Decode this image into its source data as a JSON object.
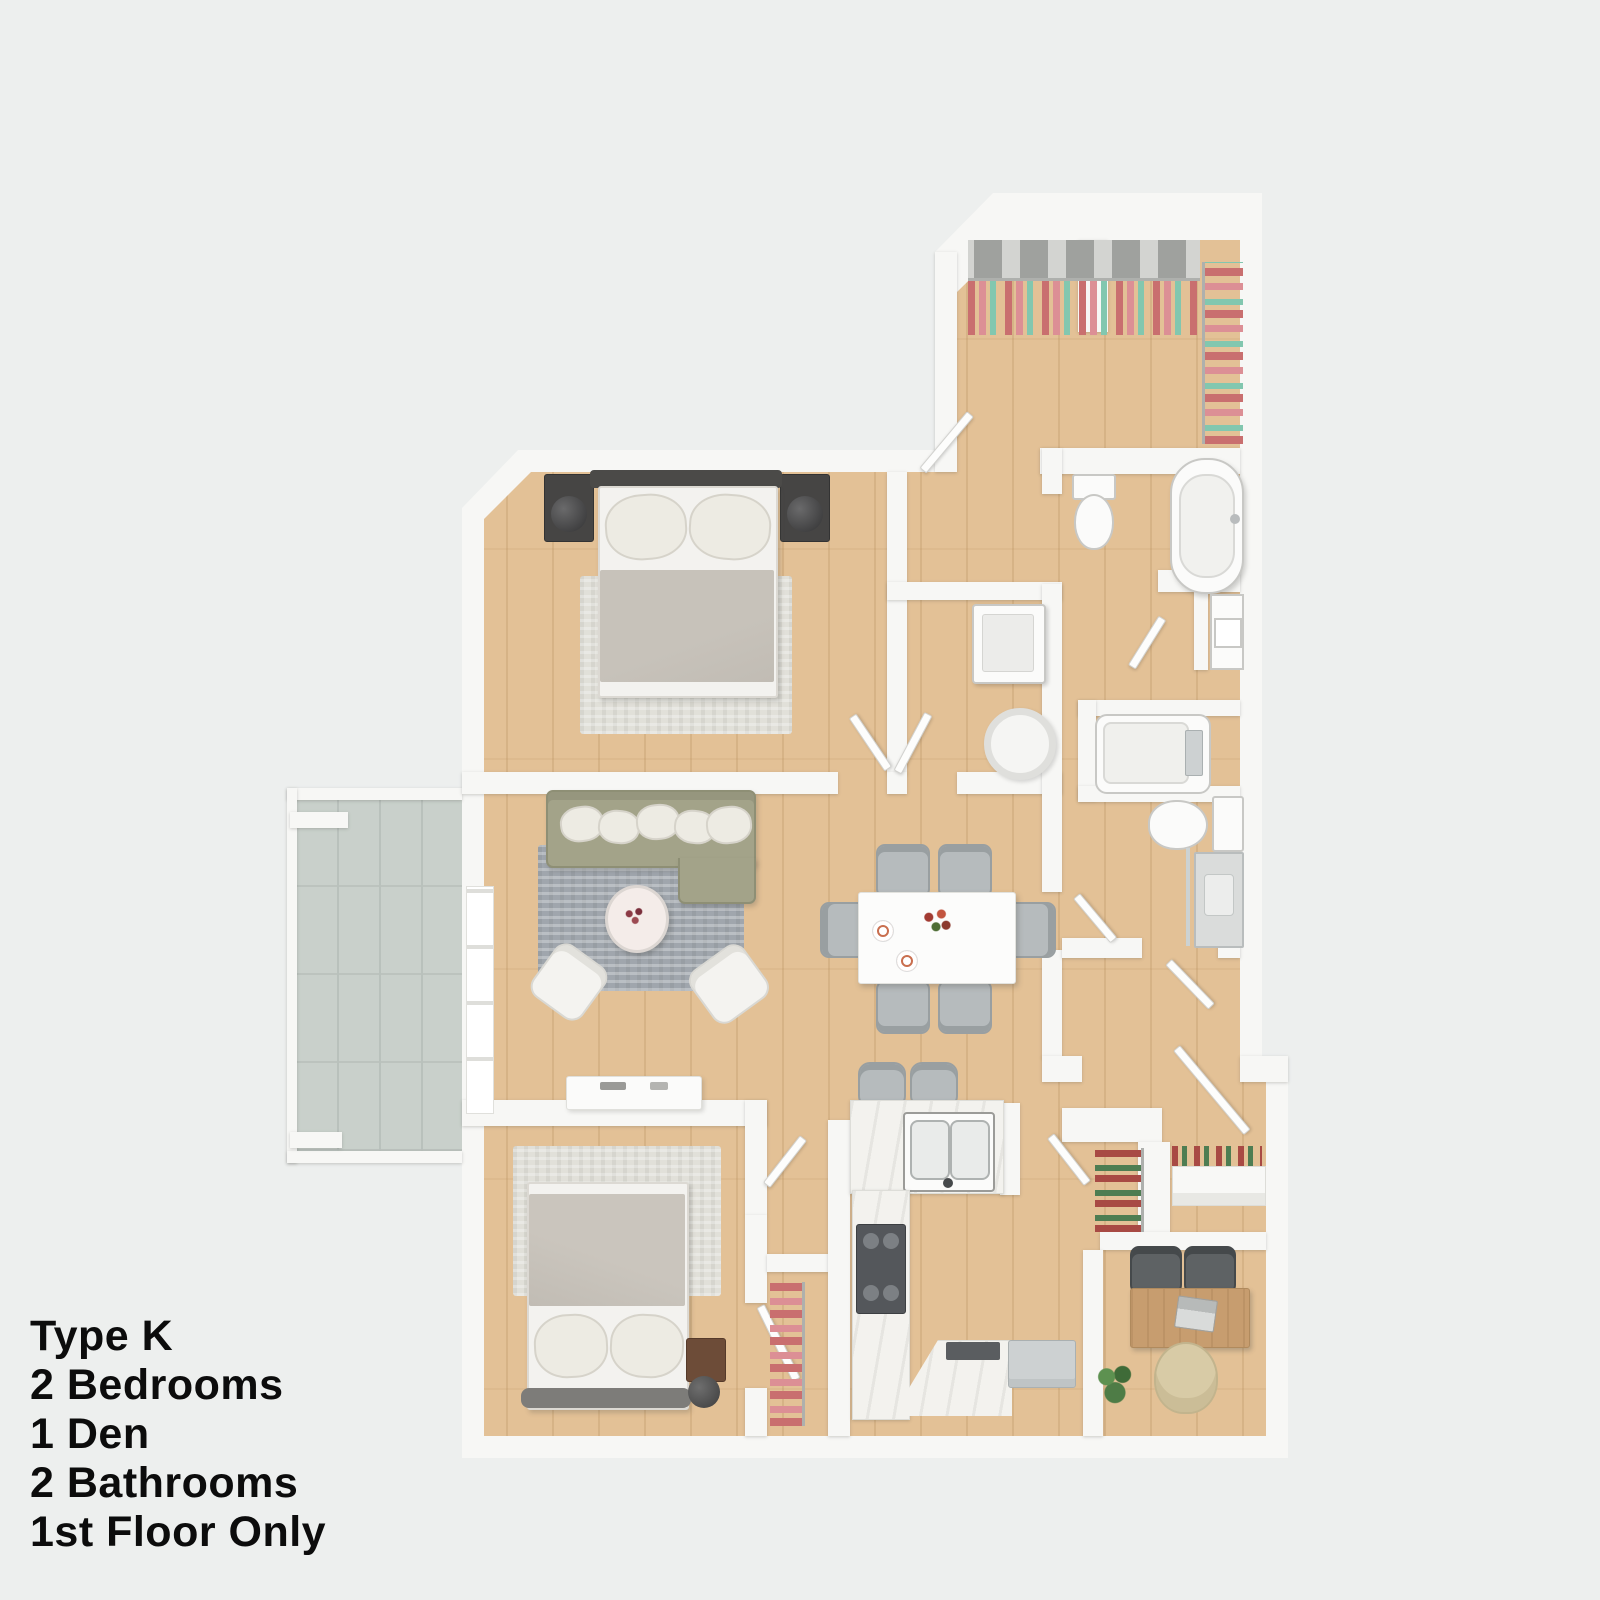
{
  "label": {
    "lines": [
      "Type K",
      "2 Bedrooms",
      "1 Den",
      "2 Bathrooms",
      "1st Floor Only"
    ]
  },
  "colors": {
    "bg": "#edefee",
    "wall": "#f7f7f5",
    "wall-shadow": "#dcddd9",
    "wood": "#e3c196",
    "wood-grain": "#c9a271",
    "concrete": "#c9d0cb",
    "concrete-line": "#b9c1bc",
    "rug-gray": "#a0a6ad",
    "rug-light": "#e1e0d9",
    "sofa": "#a3a389",
    "sofa-edge": "#8e8f75",
    "pillow": "#edebe3",
    "chair-gray": "#b6bbbd",
    "chair-edge": "#999fa1",
    "dark-furniture": "#464544",
    "blanket": "#c1bcb4",
    "sheet": "#f3f2ef",
    "fixture": "#fbfbfa",
    "fixture-edge": "#c8c8c5",
    "counter": "#f3f2ee",
    "steel": "#cdd1d2",
    "stove": "#54575b",
    "desk-wood": "#c79d6f",
    "office-chair": "#d8cba6",
    "plant": "#4e7c46",
    "clothes-rose": "#c96f6f",
    "clothes-pink": "#dc8f95",
    "clothes-teal": "#82c7af",
    "clothes-red": "#a84a44",
    "clothes-green": "#4e7d52",
    "text": "#0c0c0c"
  }
}
